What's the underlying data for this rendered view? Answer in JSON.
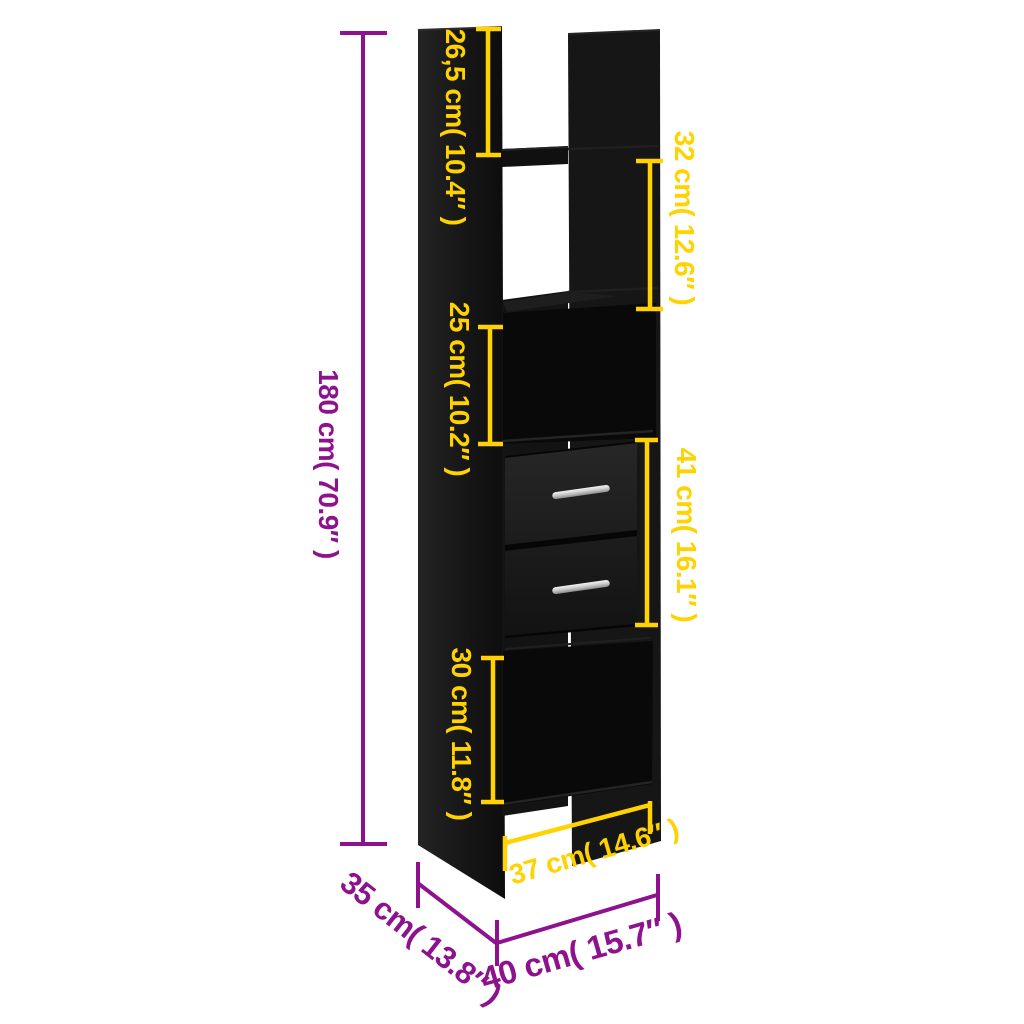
{
  "colors": {
    "dimension_yellow": "#ffd200",
    "dimension_purple": "#8e128e",
    "furniture_black": "#141414",
    "handle_silver": "#c9c9c9",
    "background": "#ffffff"
  },
  "dimensions": {
    "total_height": {
      "label": "180 cm( 70.9″ )",
      "color": "purple"
    },
    "top_opening_height": {
      "label": "26,5 cm( 10.4″ )",
      "color": "yellow"
    },
    "upper_shelf_height": {
      "label": "32 cm( 12.6″ )",
      "color": "yellow"
    },
    "middle_shelf_height": {
      "label": "25 cm( 10.2″ )",
      "color": "yellow"
    },
    "drawer_section_height": {
      "label": "41 cm( 16.1″ )",
      "color": "yellow"
    },
    "lower_opening_height": {
      "label": "30 cm( 11.8″ )",
      "color": "yellow"
    },
    "inner_width": {
      "label": "37 cm( 14.6″ )",
      "color": "yellow"
    },
    "depth": {
      "label": "35 cm( 13.8″ )",
      "color": "purple"
    },
    "width": {
      "label": "40 cm( 15.7″ )",
      "color": "purple"
    }
  }
}
